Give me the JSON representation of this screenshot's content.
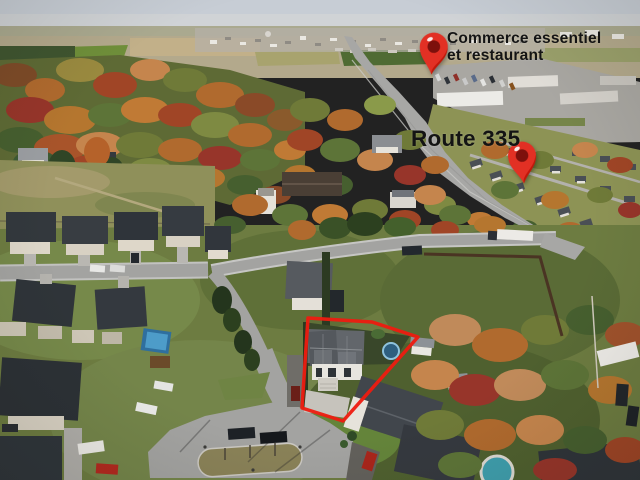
{
  "image": {
    "description": "Aerial drone photo of a suburban neighborhood in autumn with real-estate annotations",
    "width": 640,
    "height": 480
  },
  "annotations": {
    "commerce_label": {
      "line1": "Commerce essentiel",
      "line2": "et restaurant",
      "x": 447,
      "y": 31,
      "font_size": 15.5,
      "color": "#141414"
    },
    "route_label": {
      "text": "Route 335",
      "x": 411,
      "y": 127,
      "font_size": 22.5,
      "color": "#141414"
    },
    "pins": [
      {
        "name": "commerce-pin",
        "tip_x": 431,
        "tip_y": 79,
        "width": 30,
        "height": 52,
        "rotation": 5,
        "body_color": "#e23024",
        "shade_color": "#b81406",
        "inner_color": "#7d100c",
        "highlight_color": "#ffffff"
      },
      {
        "name": "route-pin",
        "tip_x": 524,
        "tip_y": 184,
        "width": 34,
        "height": 44,
        "rotation": -4,
        "body_color": "#e23024",
        "shade_color": "#b81406",
        "inner_color": "#7d100c",
        "highlight_color": "#ffffff"
      }
    ],
    "property_outline": {
      "points": "308,318 372,322 418,337 343,421 302,408",
      "stroke": "#ee1b10",
      "stroke_width": 3.5
    }
  },
  "palette": {
    "sky": "#c7cdd5",
    "farmland": "#b3a98c",
    "autumn_orange": "#b06a2e",
    "autumn_red": "#97352a",
    "tree_green": "#465f2f",
    "road": "#a5a5a3",
    "roof_dark": "#33383d",
    "wall_light": "#e7e4dc",
    "lawn": "#6d7c41",
    "pool_blue": "#3e85b4"
  }
}
